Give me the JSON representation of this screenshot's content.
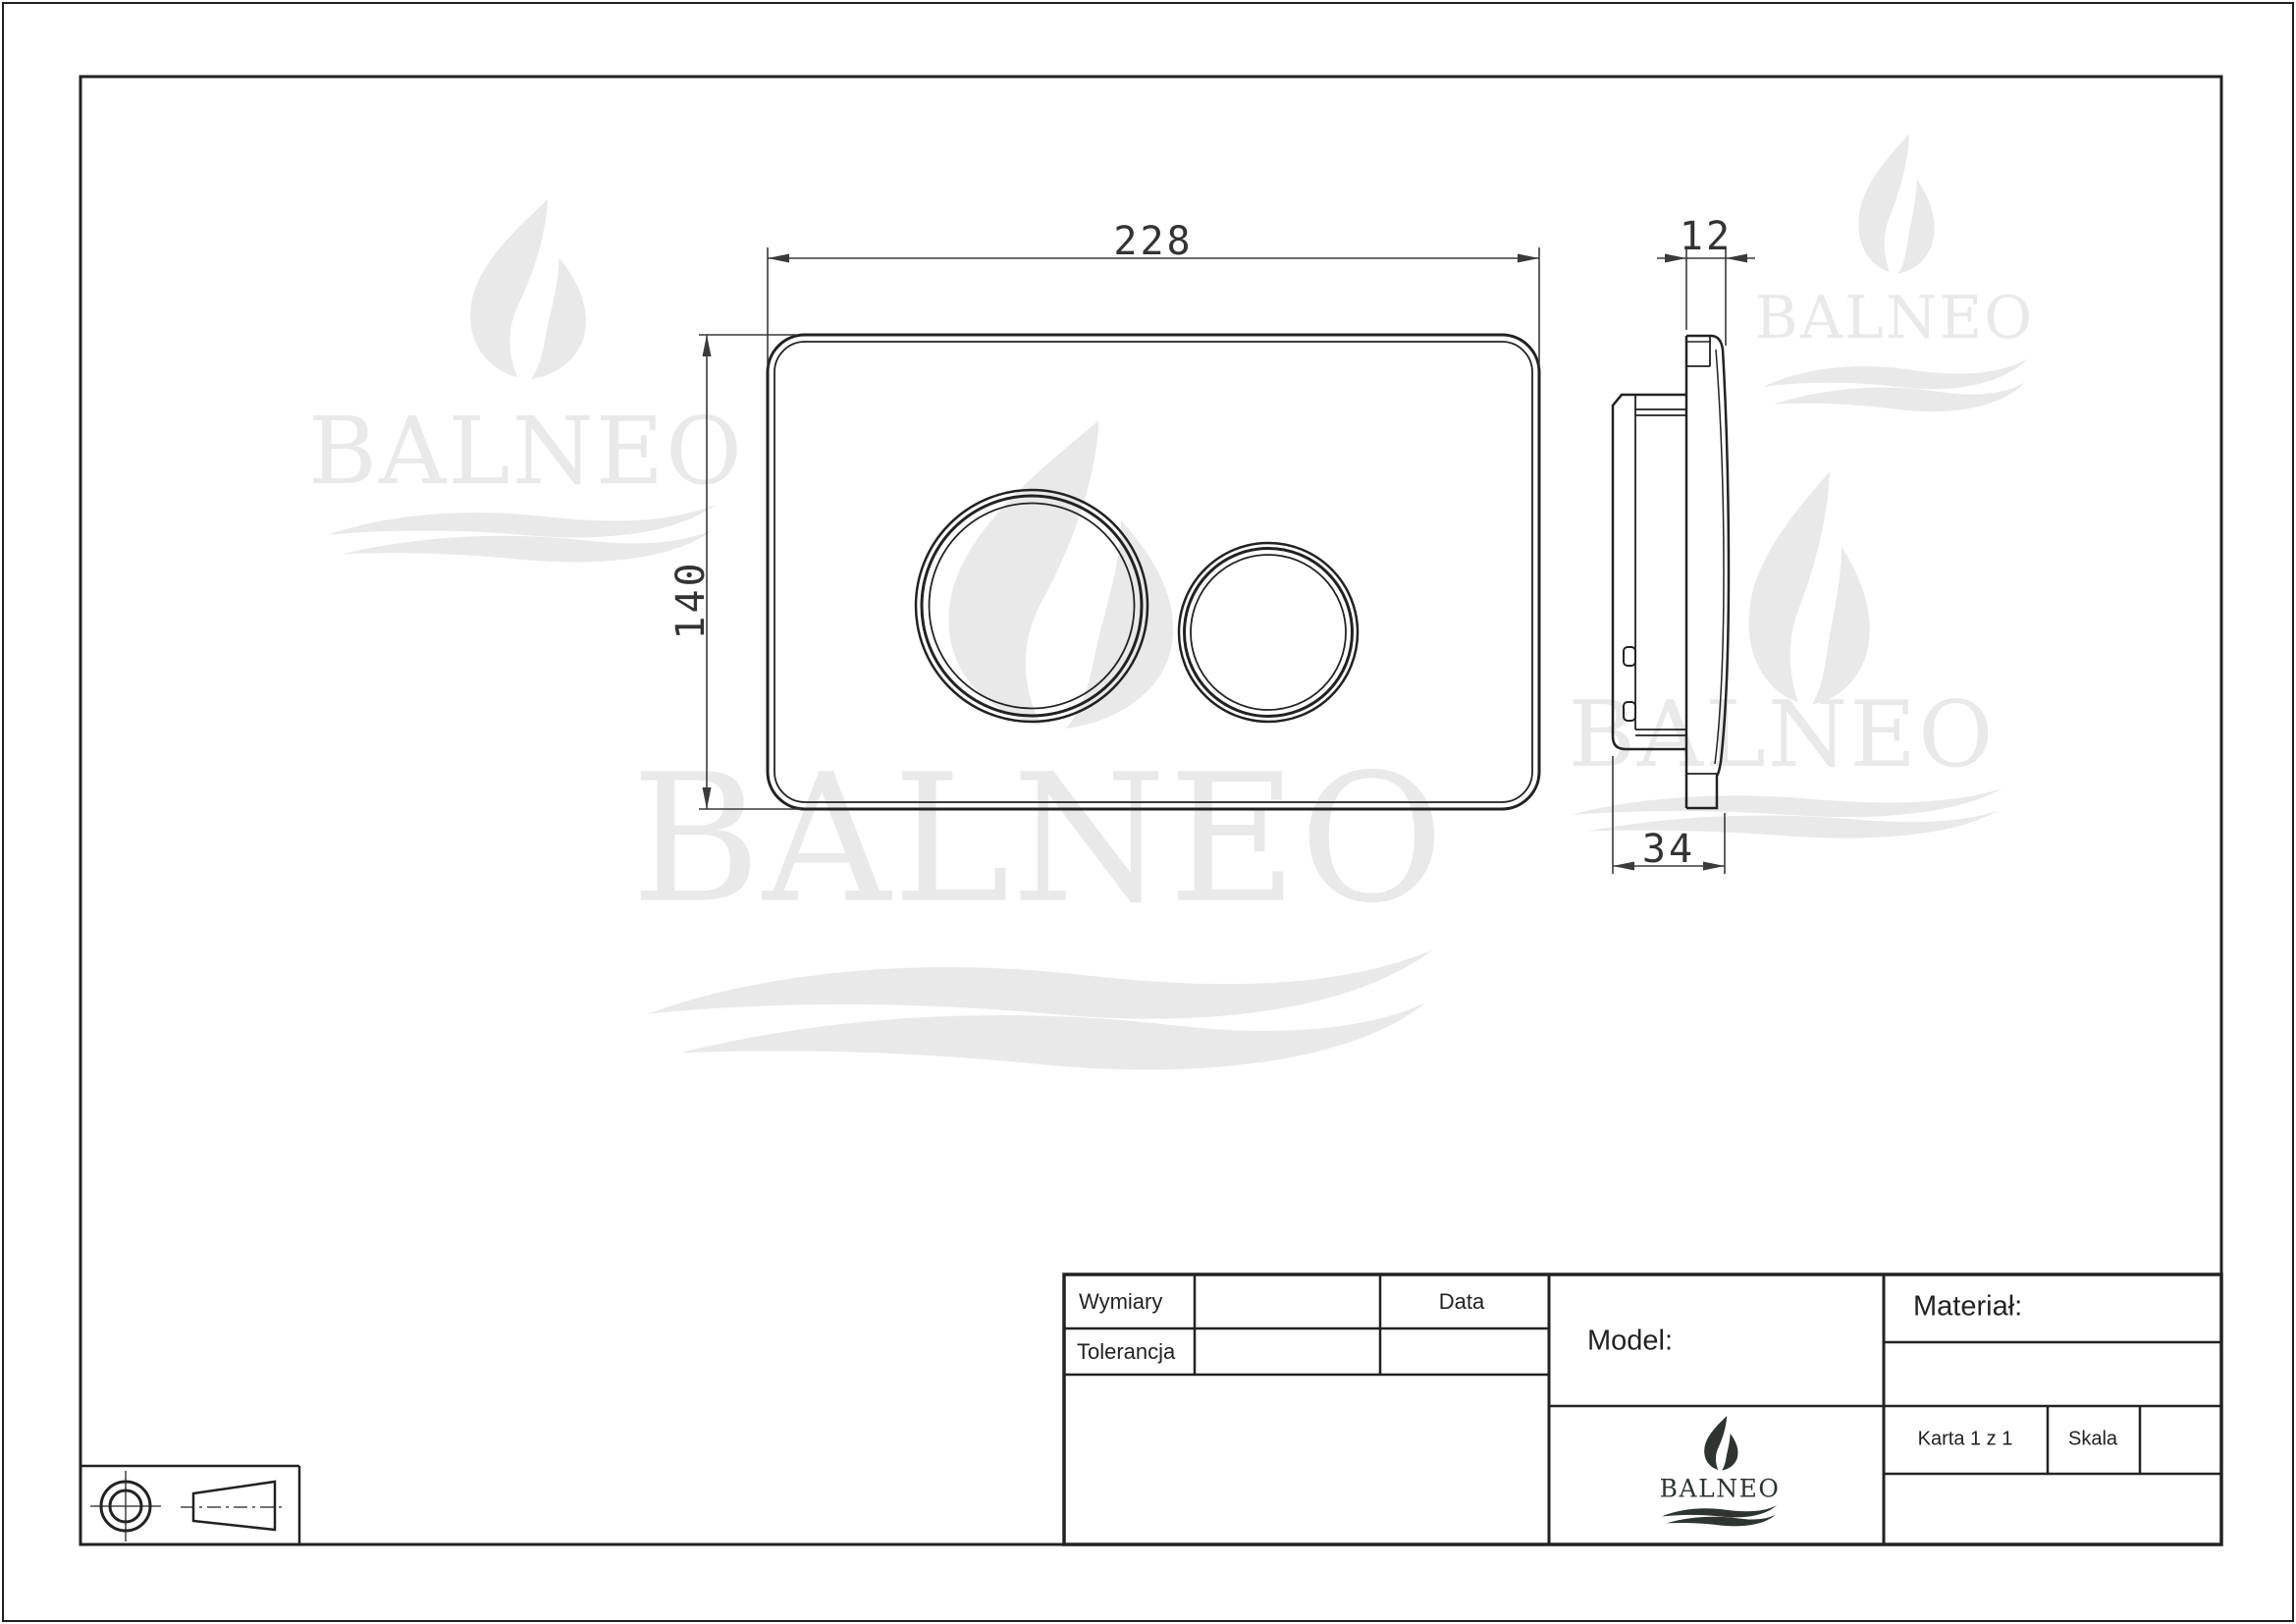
{
  "brand": {
    "name": "BALNEO"
  },
  "dims": {
    "width": "228",
    "height": "140",
    "thickness": "12",
    "depth": "34"
  },
  "title_block": {
    "wymiary": "Wymiary",
    "tolerancja": "Tolerancja",
    "data": "Data",
    "model": "Model:",
    "material": "Materiał:",
    "karta": "Karta 1 z 1",
    "skala": "Skala"
  },
  "colors": {
    "line": "#222222",
    "dimension": "#3a3a3a",
    "watermark": "#e9e9e9",
    "logo": "#2e3430"
  }
}
